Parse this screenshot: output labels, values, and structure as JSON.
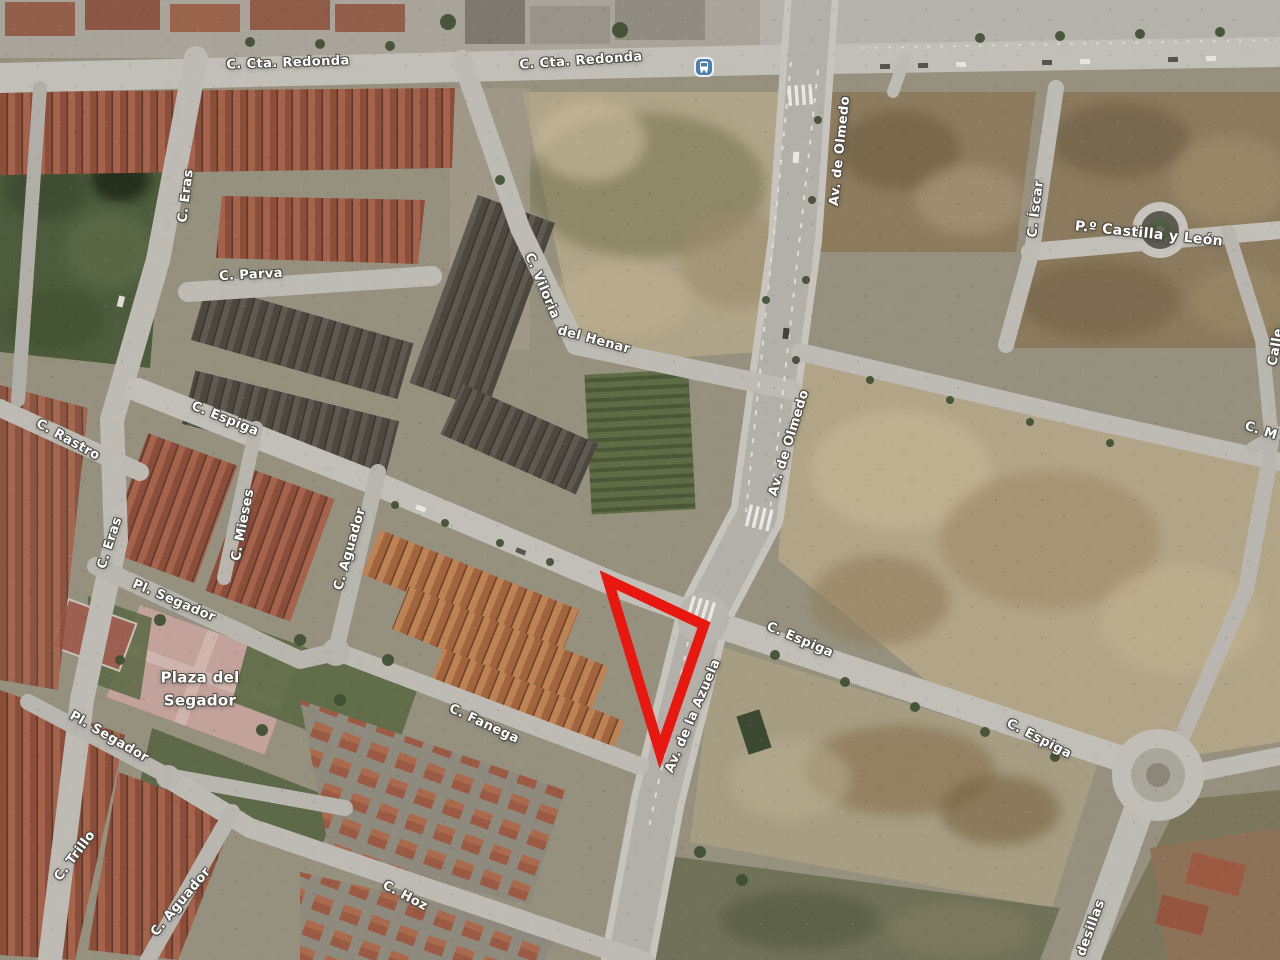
{
  "map": {
    "view_type": "satellite aerial imagery",
    "labels": {
      "cta_redonda_1": "C. Cta. Redonda",
      "cta_redonda_2": "C. Cta. Redonda",
      "eras_top": "C. Eras",
      "parva": "C. Parva",
      "viloria": "C. Viloria",
      "del_henar": "del Henar",
      "olmedo_top": "Av. de Olmedo",
      "olmedo_mid": "Av. de Olmedo",
      "iscar": "C. Íscar",
      "castilla_leon": "P.º Castilla y León",
      "calle_edge": "Calle",
      "cm_edge": "C. M",
      "rastro": "C. Rastro",
      "espiga_left": "C. Espiga",
      "eras_mid": "C. Eras",
      "mieses": "C. Mieses",
      "pl_segador_upper": "Pl. Segador",
      "aguador_upper": "C. Aguador",
      "pl_segador_lower": "Pl. Segador",
      "trillo": "C. Trillo",
      "aguador_lower": "C. Aguador",
      "fanega": "C. Fanega",
      "hoz": "C. Hoz",
      "azuela": "Av. de la Azuela",
      "espiga_mid": "C. Espiga",
      "espiga_right": "C. Espiga",
      "desillas": "desillas"
    },
    "place_labels": {
      "plaza_del_segador": {
        "line1": "Plaza del",
        "line2": "Segador"
      }
    },
    "icons": {
      "bus_stop": "bus-stop-icon"
    }
  },
  "annotation": {
    "shape": "triangle",
    "color": "#e8170f",
    "stroke_width": 10.5,
    "points": "608,580 704,625 660,752"
  },
  "colors": {
    "road": "#c1bfb8",
    "dirt_lot": "#b0a488",
    "vegetation": "#46543a",
    "roof_red": "#a4634a",
    "roof_gray": "#5e5a52",
    "plaza_pink": "#c2a29a",
    "label_text": "#ffffff",
    "bus_icon_blue": "#4a7fae"
  }
}
